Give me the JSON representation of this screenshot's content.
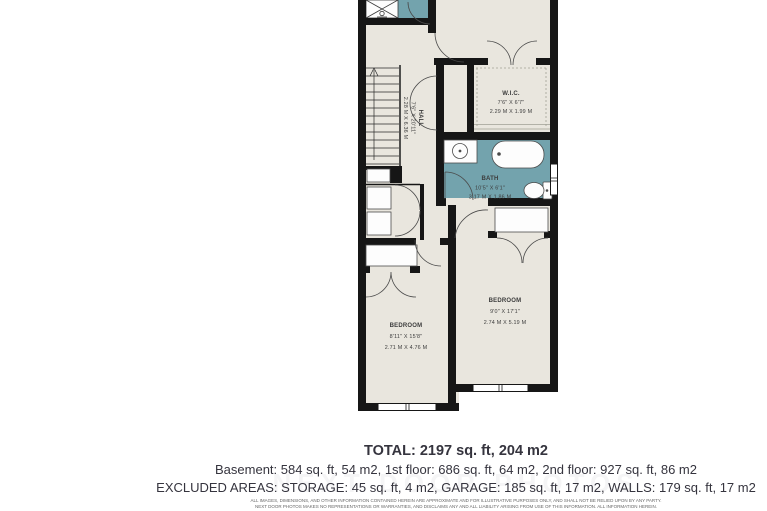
{
  "plan": {
    "hall": {
      "label": "HALL",
      "imperial": "7'6\" X 20'11\"",
      "metric": "2.28 M X 6.36 M"
    },
    "wic": {
      "label": "W.I.C.",
      "imperial": "7'6\" X 6'7\"",
      "metric": "2.29 M X 1.99 M"
    },
    "bath": {
      "label": "BATH",
      "imperial": "10'5\" X 6'1\"",
      "metric": "3.17 M X 1.86 M"
    },
    "bedroom_left": {
      "label": "BEDROOM",
      "imperial": "8'11\" X 15'8\"",
      "metric": "2.71 M X 4.76 M"
    },
    "bedroom_right": {
      "label": "BEDROOM",
      "imperial": "9'0\" X 17'1\"",
      "metric": "2.74 M X 5.19 M"
    },
    "colors": {
      "floor": "#e9e6de",
      "wall": "#161616",
      "wet_area": "#73a3ad",
      "fixture": "#fdfdfd"
    }
  },
  "summary": {
    "total": "TOTAL: 2197 sq. ft, 204 m2",
    "floors": "Basement: 584 sq. ft, 54 m2, 1st floor: 686 sq. ft, 64 m2, 2nd floor: 927 sq. ft, 86 m2",
    "excluded": "EXCLUDED AREAS: STORAGE: 45 sq. ft, 4 m2, GARAGE: 185 sq. ft, 17 m2, WALLS: 179 sq. ft, 17 m2",
    "disclaimer_line1": "ALL IMAGES, DIMENSIONS, AND OTHER INFORMATION CONTAINED HEREIN ARE APPROXIMATE AND FOR ILLUSTRATIVE PURPOSES ONLY, AND SHALL NOT BE RELIED UPON BY ANY PARTY.",
    "disclaimer_line2": "NEXT DOOR PHOTOS MAKES NO REPRESENTATIONS OR WARRANTIES, AND DISCLAIMS ANY AND ALL LIABILITY ARISING FROM USE OF THIS INFORMATION. ALL INFORMATION HEREIN.",
    "watermark": "NEXT DOOR PHOTOS"
  }
}
